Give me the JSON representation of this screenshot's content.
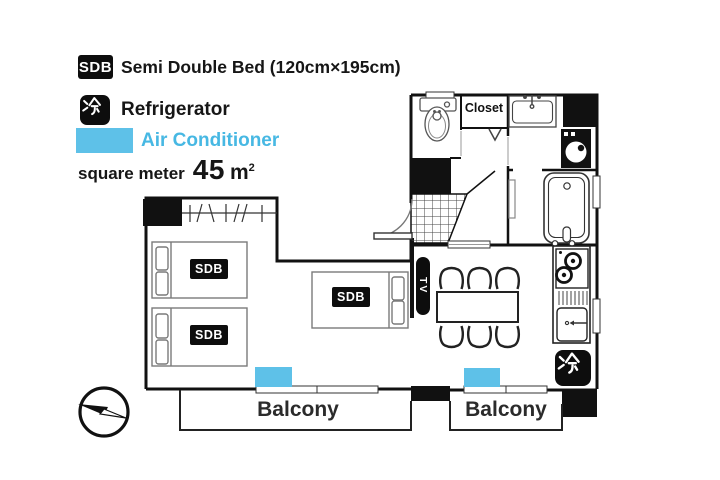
{
  "legend": {
    "sdb_badge": "SDB",
    "sdb_label": "Semi Double Bed (120cm×195cm)",
    "rei_badge": "冷",
    "rei_label": "Refrigerator",
    "ac_label": "Air Conditioner",
    "area_label": "square meter",
    "area_value": "45",
    "area_unit": "m",
    "area_sup": "2"
  },
  "plan": {
    "closet": "Closet",
    "tv": "TV",
    "rei": "冷",
    "balcony_left": "Balcony",
    "balcony_right": "Balcony",
    "beds": [
      {
        "badge": "SDB",
        "size": "120cm×195cm"
      },
      {
        "badge": "SDB",
        "size": "120cm×195cm"
      },
      {
        "badge": "SDB",
        "size": "120cm×195cm"
      }
    ],
    "icons": [
      "toilet-icon",
      "washbasin-icon",
      "washing-machine-icon",
      "bathtub-icon",
      "stove-icon",
      "kitchen-sink-icon",
      "dining-table",
      "chairs",
      "entry-door-arc",
      "entry-tile",
      "compass-icon",
      "refrigerator-kanji-icon",
      "tv-badge",
      "air-conditioner-unit"
    ]
  },
  "colors": {
    "accent_blue": "#5ec1e8",
    "ac_text_blue": "#47b8e3",
    "ink": "#111111"
  }
}
